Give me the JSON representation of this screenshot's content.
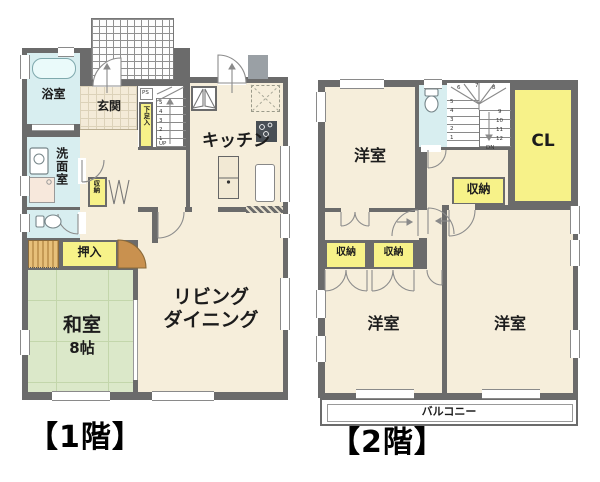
{
  "floor1": {
    "title": "【1階】",
    "rooms": {
      "bath": "浴室",
      "entrance": "玄関",
      "washroom": "洗面室",
      "kitchen": "キッチン",
      "living_line1": "リビング",
      "living_line2": "ダイニング",
      "japanese_room_line1": "和室",
      "japanese_room_line2": "8帖",
      "oshiire_closet": "押入",
      "storage": "収納",
      "shoe_cabinet": "下足入",
      "pipe_space": "PS"
    },
    "stairs": {
      "numbers": [
        "5",
        "4",
        "3",
        "2",
        "1"
      ],
      "direction": "UP"
    }
  },
  "floor2": {
    "title": "【2階】",
    "rooms": {
      "bedroom": "洋室",
      "closet_cl": "CL",
      "storage": "収納",
      "balcony": "バルコニー"
    },
    "stairs": {
      "left_numbers": [
        "5",
        "4",
        "3",
        "2",
        "1"
      ],
      "right_numbers": [
        "9",
        "10",
        "11",
        "12"
      ],
      "top_numbers": [
        "6",
        "7",
        "8"
      ],
      "direction": "DN"
    }
  },
  "colors": {
    "wall": "#6b6b6b",
    "room_cream": "#f6eedb",
    "wet_area_blue": "#d8eef0",
    "storage_yellow": "#f7f289",
    "tatami_green": "#dbe8c9",
    "wood_closet": "#c59a55"
  }
}
